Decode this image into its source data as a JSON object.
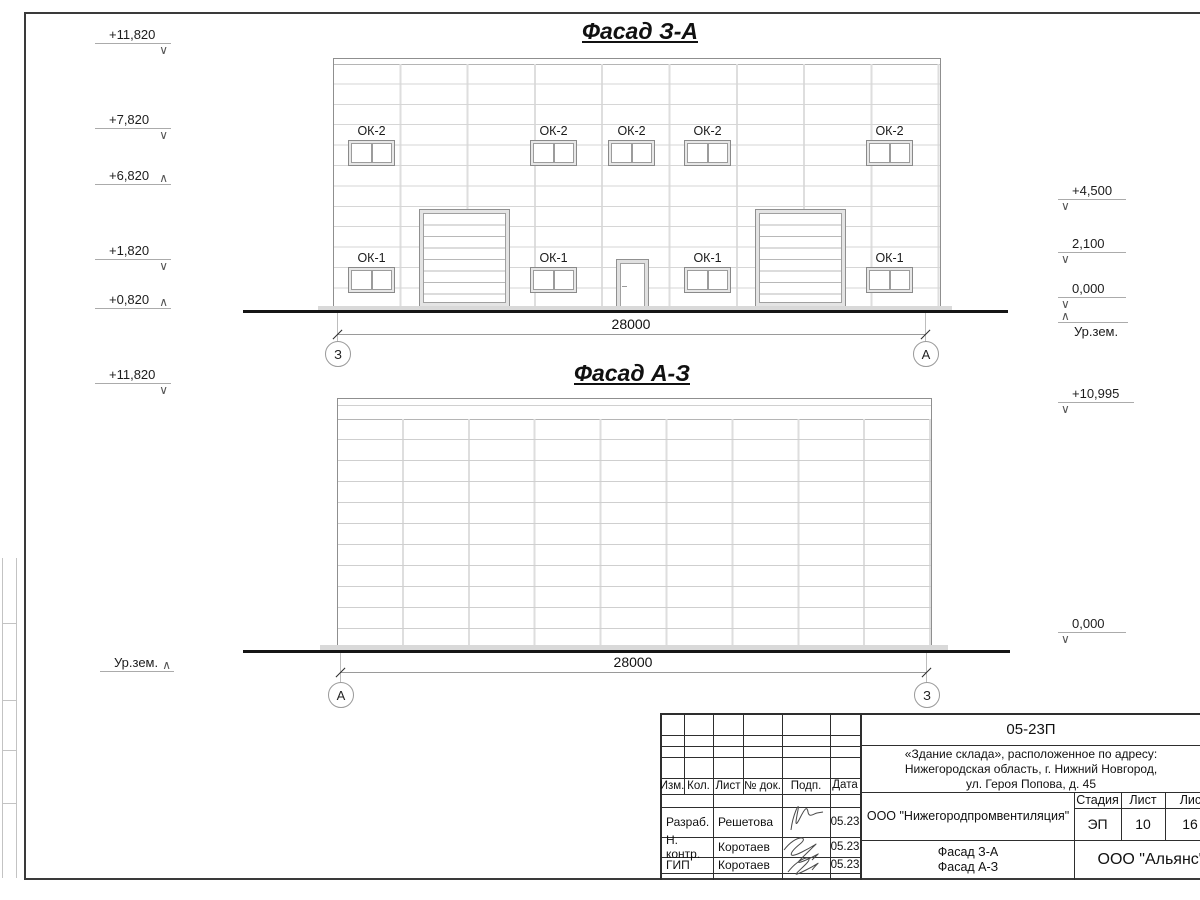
{
  "icons": {
    "elev_down": "∨",
    "elev_up": "∧"
  },
  "facade1": {
    "title": "Фасад З-А",
    "upper_window_label": "ОК-2",
    "lower_window_label": "ОК-1",
    "dimension": "28000",
    "axis_left": "З",
    "axis_right": "А",
    "elev": {
      "e11820": "+11,820",
      "e7820": "+7,820",
      "e6820": "+6,820",
      "e1820": "+1,820",
      "e0820": "+0,820",
      "e4500": "+4,500",
      "e2100": "2,100",
      "e0000": "0,000",
      "ground": "Ур.зем."
    }
  },
  "facade2": {
    "title": "Фасад А-З",
    "dimension": "28000",
    "axis_left": "А",
    "axis_right": "З",
    "elev": {
      "e11820": "+11,820",
      "e10995": "+10,995",
      "e0000": "0,000",
      "ground": "Ур.зем."
    }
  },
  "titleblock": {
    "code": "05-23П",
    "address1": "«Здание склада», расположенное по адресу:",
    "address2": "Нижегородская область, г. Нижний Новгород,",
    "address3": "ул. Героя Попова, д. 45",
    "col_izm": "Изм.",
    "col_kol": "Кол.",
    "col_list": "Лист",
    "col_ndok": "№ док.",
    "col_podp": "Подп.",
    "col_data": "Дата",
    "row1_role": "Разраб.",
    "row1_name": "Решетова",
    "row1_date": "05.23",
    "row2_role": "Н. контр.",
    "row2_name": "Коротаев",
    "row2_date": "05.23",
    "row3_role": "ГИП",
    "row3_name": "Коротаев",
    "row3_date": "05.23",
    "org": "ООО \"Нижегородпромвентиляция\"",
    "stage_label": "Стадия",
    "sheet_label": "Лист",
    "sheets_label": "Листов",
    "stage": "ЭП",
    "sheet_num": "10",
    "sheets_total": "16",
    "dwg1": "Фасад З-А",
    "dwg2": "Фасад А-З",
    "company": "ООО \"Альянс\""
  }
}
